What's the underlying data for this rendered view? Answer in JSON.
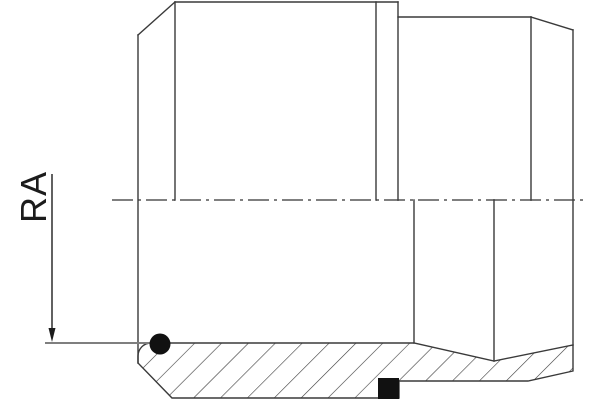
{
  "drawing": {
    "type": "technical-section-drawing",
    "dimension_label": "RA",
    "colors": {
      "background": "#ffffff",
      "outline": "#3a3a3a",
      "centerline": "#7f7f7f",
      "dimension_line": "#7f7f7f",
      "seal_fill": "#111111",
      "hatch": "#3a3a3a"
    },
    "elements": {
      "o_ring": "round seal cross-section, bottom left",
      "seal_ring": "square seal cross-section, bottom right",
      "section": "hatched lower wall section",
      "centerline": "horizontal dash-dot axis line"
    }
  }
}
